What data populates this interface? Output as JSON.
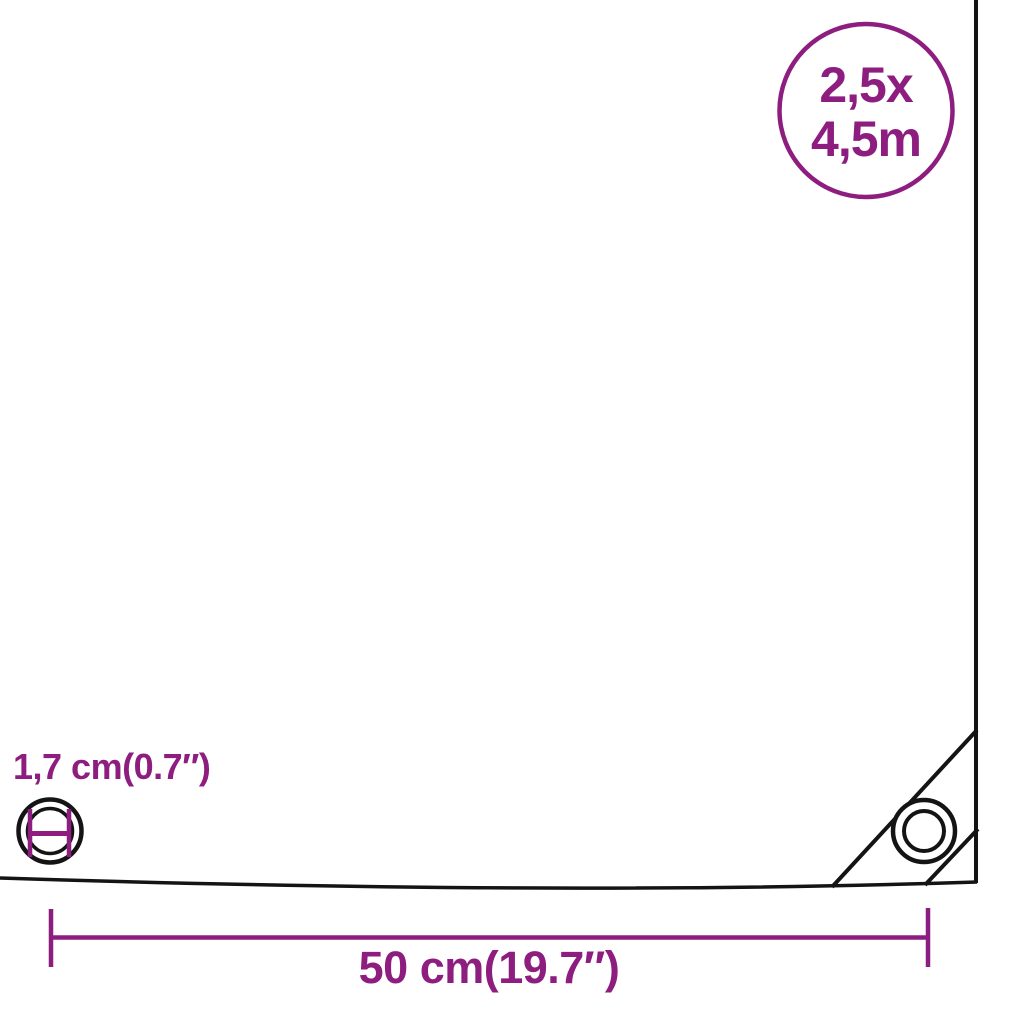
{
  "diagram": {
    "kind": "tarpaulin-dimension-diagram",
    "size_badge": {
      "line1": "2,5x",
      "line2": "4,5m"
    },
    "grommet": {
      "diameter_label": "1,7 cm(0.7″)"
    },
    "spacing": {
      "label": "50 cm(19.7″)"
    },
    "icons": {
      "size_badge_circle": "outlined-circle",
      "grommet_diameter_icon": "circle-with-diameter-measure-bars",
      "corner_grommet_icon": "concentric-circles-eyelet",
      "width_measure": "horizontal-line-with-end-ticks"
    },
    "colors": {
      "accent_purple": "#8D1E80",
      "line_black": "#141414",
      "background": "#FFFFFF"
    }
  }
}
